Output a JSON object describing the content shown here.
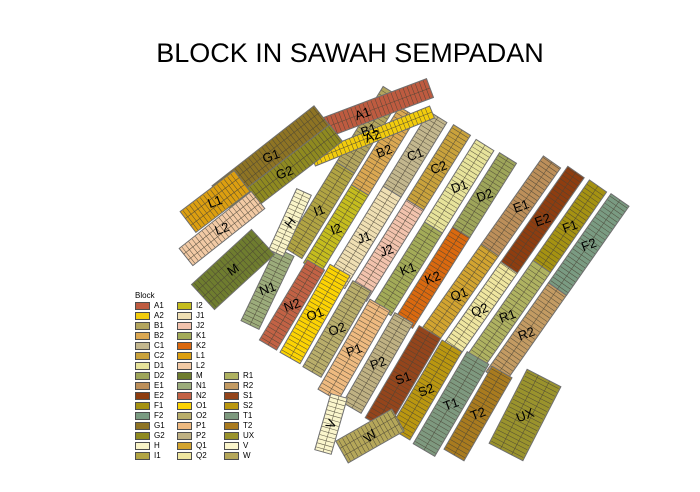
{
  "title": "BLOCK IN SAWAH SEMPADAN",
  "legend": {
    "title": "Block",
    "columns": [
      {
        "row_offset": 0,
        "ids": [
          "A1",
          "A2",
          "B1",
          "B2",
          "C1",
          "C2",
          "D1",
          "D2",
          "E1",
          "E2",
          "F1",
          "F2",
          "G1",
          "G2",
          "H",
          "I1"
        ]
      },
      {
        "row_offset": 0,
        "ids": [
          "I2",
          "J1",
          "J2",
          "K1",
          "K2",
          "L1",
          "L2",
          "M",
          "N1",
          "N2",
          "O1",
          "O2",
          "P1",
          "P2",
          "Q1",
          "Q2"
        ]
      },
      {
        "row_offset": 7,
        "ids": [
          "R1",
          "R2",
          "S1",
          "S2",
          "T1",
          "T2",
          "UX",
          "V",
          "W"
        ]
      }
    ]
  },
  "colors": {
    "A1": "#BE5B40",
    "A2": "#F2CC0D",
    "B1": "#B3A55E",
    "B2": "#DBA852",
    "C1": "#C3B78E",
    "C2": "#C9A23C",
    "D1": "#E7E39B",
    "D2": "#9EA55A",
    "E1": "#BC8F5A",
    "E2": "#8E3D10",
    "F1": "#A59212",
    "F2": "#7A9B82",
    "G1": "#8E7424",
    "G2": "#8F8A20",
    "H": "#F9F4C8",
    "I1": "#B1A443",
    "I2": "#C5BD1E",
    "J1": "#EFDFB3",
    "J2": "#F2C3AD",
    "K1": "#A3AB58",
    "K2": "#DA690F",
    "L1": "#DC9F10",
    "L2": "#F2CAA5",
    "M": "#6F7D2F",
    "N1": "#9CAC7B",
    "N2": "#C26245",
    "O1": "#FCD303",
    "O2": "#B9AE6B",
    "P1": "#EEBA80",
    "P2": "#BFB183",
    "Q1": "#D2A430",
    "Q2": "#EFE6A0",
    "R1": "#AFB261",
    "R2": "#C39B63",
    "S1": "#94451C",
    "S2": "#BA9710",
    "T1": "#7E997F",
    "T2": "#A97B1F",
    "UX": "#9A932D",
    "V": "#FAF5CC",
    "W": "#B5A75A"
  },
  "map": {
    "outline_color": "#6f6f6f",
    "parcel_line_color": "#4a4436",
    "label_color": "#000000",
    "strips": [
      {
        "x1": 293,
        "y1": 253,
        "x2": 392,
        "y2": 92,
        "w": 21,
        "blocks": [
          {
            "id": "I1",
            "f": 0.53
          },
          {
            "id": "B1",
            "f": 1
          }
        ]
      },
      {
        "x1": 312,
        "y1": 268,
        "x2": 408,
        "y2": 112,
        "w": 20,
        "blocks": [
          {
            "id": "I2",
            "f": 0.5
          },
          {
            "id": "B2",
            "f": 1
          }
        ]
      },
      {
        "x1": 336,
        "y1": 283,
        "x2": 438,
        "y2": 117,
        "w": 21,
        "blocks": [
          {
            "id": "J1",
            "f": 0.55
          },
          {
            "id": "C1",
            "f": 1
          }
        ]
      },
      {
        "x1": 358,
        "y1": 296,
        "x2": 462,
        "y2": 130,
        "w": 20,
        "blocks": [
          {
            "id": "J2",
            "f": 0.55
          },
          {
            "id": "C2",
            "f": 1
          }
        ]
      },
      {
        "x1": 382,
        "y1": 310,
        "x2": 485,
        "y2": 145,
        "w": 21,
        "blocks": [
          {
            "id": "K1",
            "f": 0.5
          },
          {
            "id": "D1",
            "f": 1
          }
        ]
      },
      {
        "x1": 404,
        "y1": 323,
        "x2": 508,
        "y2": 158,
        "w": 20,
        "blocks": [
          {
            "id": "K2",
            "f": 0.55
          },
          {
            "id": "D2",
            "f": 1
          }
        ]
      },
      {
        "x1": 428,
        "y1": 338,
        "x2": 552,
        "y2": 162,
        "w": 21,
        "blocks": [
          {
            "id": "Q1",
            "f": 0.5
          },
          {
            "id": "E1",
            "f": 1
          }
        ]
      },
      {
        "x1": 450,
        "y1": 352,
        "x2": 576,
        "y2": 172,
        "w": 20,
        "blocks": [
          {
            "id": "Q2",
            "f": 0.47
          },
          {
            "id": "E2",
            "f": 1
          }
        ]
      },
      {
        "x1": 473,
        "y1": 365,
        "x2": 598,
        "y2": 186,
        "w": 21,
        "blocks": [
          {
            "id": "R1",
            "f": 0.55
          },
          {
            "id": "F1",
            "f": 1
          }
        ]
      },
      {
        "x1": 495,
        "y1": 378,
        "x2": 620,
        "y2": 200,
        "w": 22,
        "blocks": [
          {
            "id": "R2",
            "f": 0.5
          },
          {
            "id": "F2",
            "f": 1
          }
        ]
      },
      {
        "x1": 250,
        "y1": 325,
        "x2": 285,
        "y2": 252,
        "w": 20,
        "blocks": [
          {
            "id": "N1",
            "f": 1
          }
        ]
      },
      {
        "x1": 268,
        "y1": 345,
        "x2": 316,
        "y2": 265,
        "w": 20,
        "blocks": [
          {
            "id": "N2",
            "f": 1
          }
        ]
      },
      {
        "x1": 290,
        "y1": 358,
        "x2": 340,
        "y2": 270,
        "w": 23,
        "blocks": [
          {
            "id": "O1",
            "f": 1
          }
        ]
      },
      {
        "x1": 312,
        "y1": 372,
        "x2": 362,
        "y2": 286,
        "w": 21,
        "blocks": [
          {
            "id": "O2",
            "f": 1
          }
        ]
      },
      {
        "x1": 328,
        "y1": 395,
        "x2": 380,
        "y2": 305,
        "w": 23,
        "blocks": [
          {
            "id": "P1",
            "f": 1
          }
        ]
      },
      {
        "x1": 352,
        "y1": 408,
        "x2": 404,
        "y2": 318,
        "w": 21,
        "blocks": [
          {
            "id": "P2",
            "f": 1
          }
        ]
      },
      {
        "x1": 376,
        "y1": 424,
        "x2": 430,
        "y2": 332,
        "w": 25,
        "blocks": [
          {
            "id": "S1",
            "f": 1
          }
        ]
      },
      {
        "x1": 400,
        "y1": 434,
        "x2": 452,
        "y2": 346,
        "w": 23,
        "blocks": [
          {
            "id": "S2",
            "f": 1
          }
        ]
      },
      {
        "x1": 424,
        "y1": 450,
        "x2": 478,
        "y2": 358,
        "w": 25,
        "blocks": [
          {
            "id": "T1",
            "f": 1
          }
        ]
      },
      {
        "x1": 454,
        "y1": 455,
        "x2": 502,
        "y2": 372,
        "w": 23,
        "blocks": [
          {
            "id": "T2",
            "f": 1
          }
        ]
      },
      {
        "x1": 506,
        "y1": 452,
        "x2": 544,
        "y2": 378,
        "w": 38,
        "rows": 3,
        "blocks": [
          {
            "id": "UX",
            "f": 1
          }
        ]
      },
      {
        "x1": 323,
        "y1": 452,
        "x2": 339,
        "y2": 396,
        "w": 17,
        "la": -65,
        "blocks": [
          {
            "id": "V",
            "f": 1
          }
        ]
      },
      {
        "x1": 342,
        "y1": 452,
        "x2": 398,
        "y2": 420,
        "w": 25,
        "rows": 3,
        "la": -40,
        "blocks": [
          {
            "id": "W",
            "f": 1
          }
        ]
      },
      {
        "x1": 295,
        "y1": 139,
        "x2": 430,
        "y2": 88,
        "w": 20,
        "blocks": [
          {
            "id": "A1",
            "f": 1
          }
        ]
      },
      {
        "x1": 313,
        "y1": 160,
        "x2": 432,
        "y2": 112,
        "w": 13,
        "blocks": [
          {
            "id": "A2",
            "f": 1
          }
        ]
      },
      {
        "x1": 220,
        "y1": 196,
        "x2": 322,
        "y2": 116,
        "w": 26,
        "rows": 3,
        "blocks": [
          {
            "id": "G1",
            "f": 1
          }
        ]
      },
      {
        "x1": 233,
        "y1": 212,
        "x2": 336,
        "y2": 133,
        "w": 21,
        "blocks": [
          {
            "id": "G2",
            "f": 1
          }
        ]
      },
      {
        "x1": 188,
        "y1": 222,
        "x2": 242,
        "y2": 181,
        "w": 26,
        "rows": 3,
        "blocks": [
          {
            "id": "L1",
            "f": 1
          }
        ]
      },
      {
        "x1": 186,
        "y1": 257,
        "x2": 258,
        "y2": 200,
        "w": 22,
        "rows": 3,
        "blocks": [
          {
            "id": "L2",
            "f": 1
          }
        ]
      },
      {
        "x1": 276,
        "y1": 253,
        "x2": 304,
        "y2": 192,
        "w": 16,
        "la": -50,
        "blocks": [
          {
            "id": "H",
            "f": 1
          }
        ]
      },
      {
        "x1": 203,
        "y1": 297,
        "x2": 263,
        "y2": 242,
        "w": 34,
        "rows": 4,
        "la": -35,
        "blocks": [
          {
            "id": "M",
            "f": 1
          }
        ]
      }
    ]
  }
}
